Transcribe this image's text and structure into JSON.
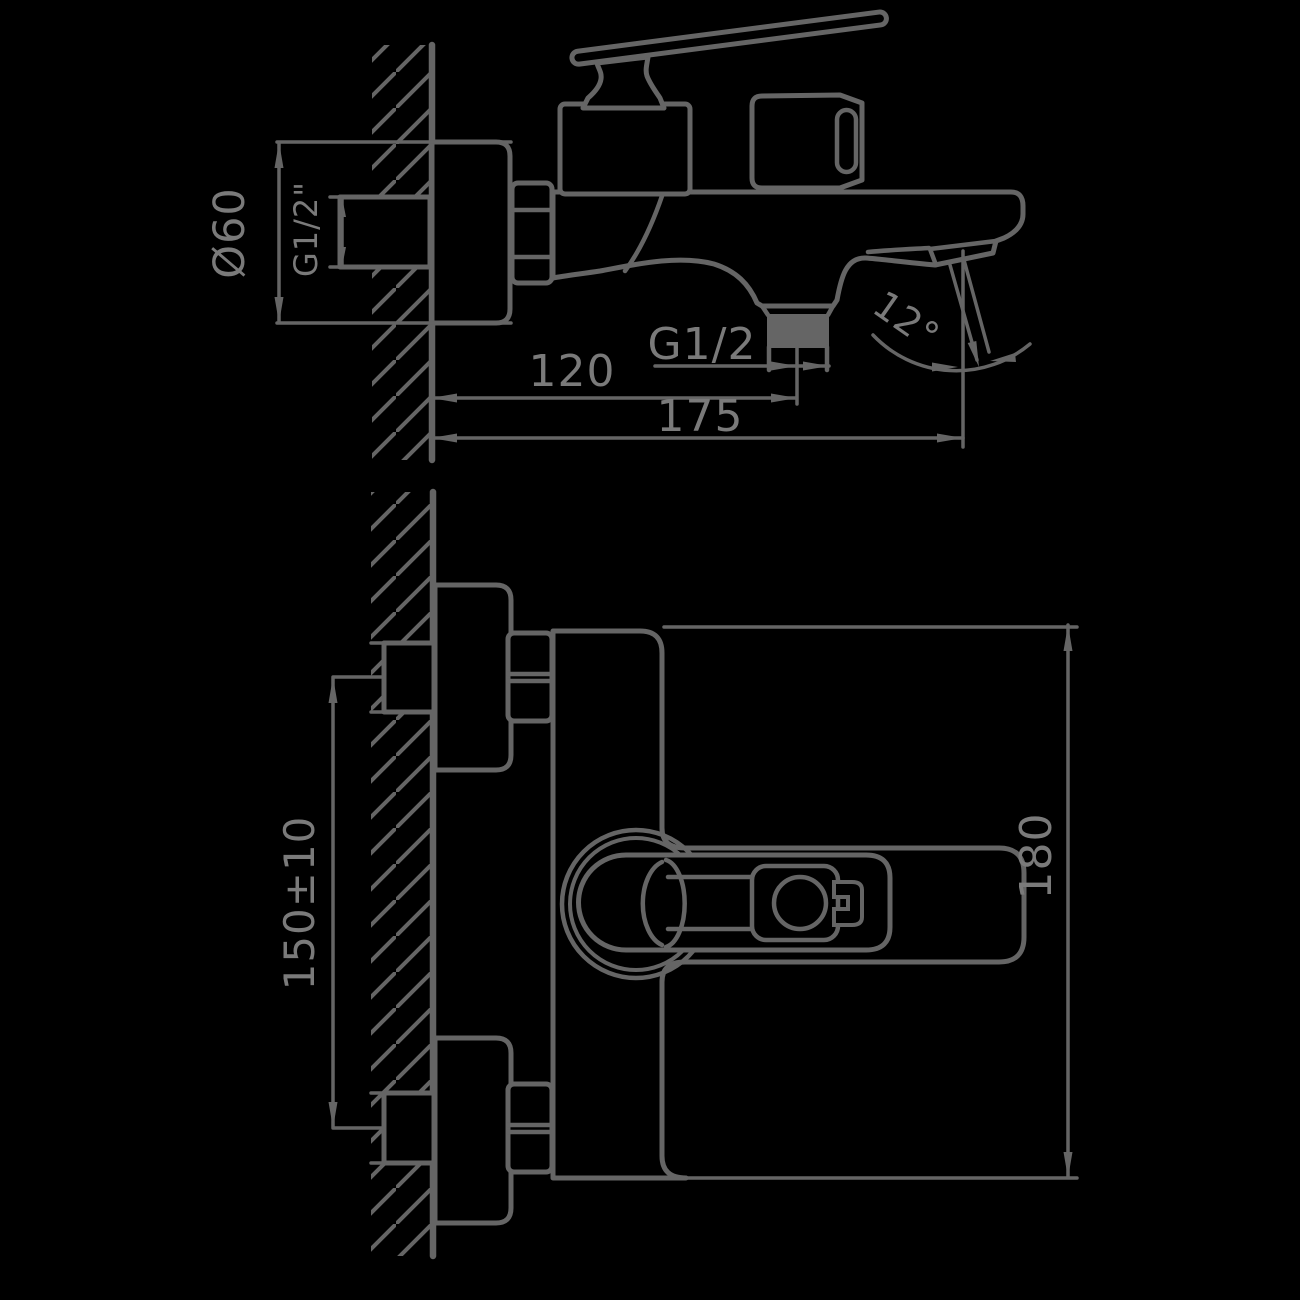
{
  "drawing": {
    "subject": "wall-mounted bath mixer faucet, two-view installation drawing",
    "colors": {
      "background": "#000000",
      "line": "#656565",
      "text": "#7a7a7a"
    },
    "views": {
      "side_view": {
        "dimensions": {
          "flange_diameter": "Ø60",
          "wall_inlet_thread": "G1/2\"",
          "wall_to_shower_outlet": "120",
          "shower_outlet_thread": "G1/2",
          "wall_to_spout_tip": "175",
          "spout_stream_angle": "12°"
        }
      },
      "front_view": {
        "dimensions": {
          "inlet_center_distance": "150±10",
          "overall_height": "180"
        }
      }
    }
  }
}
